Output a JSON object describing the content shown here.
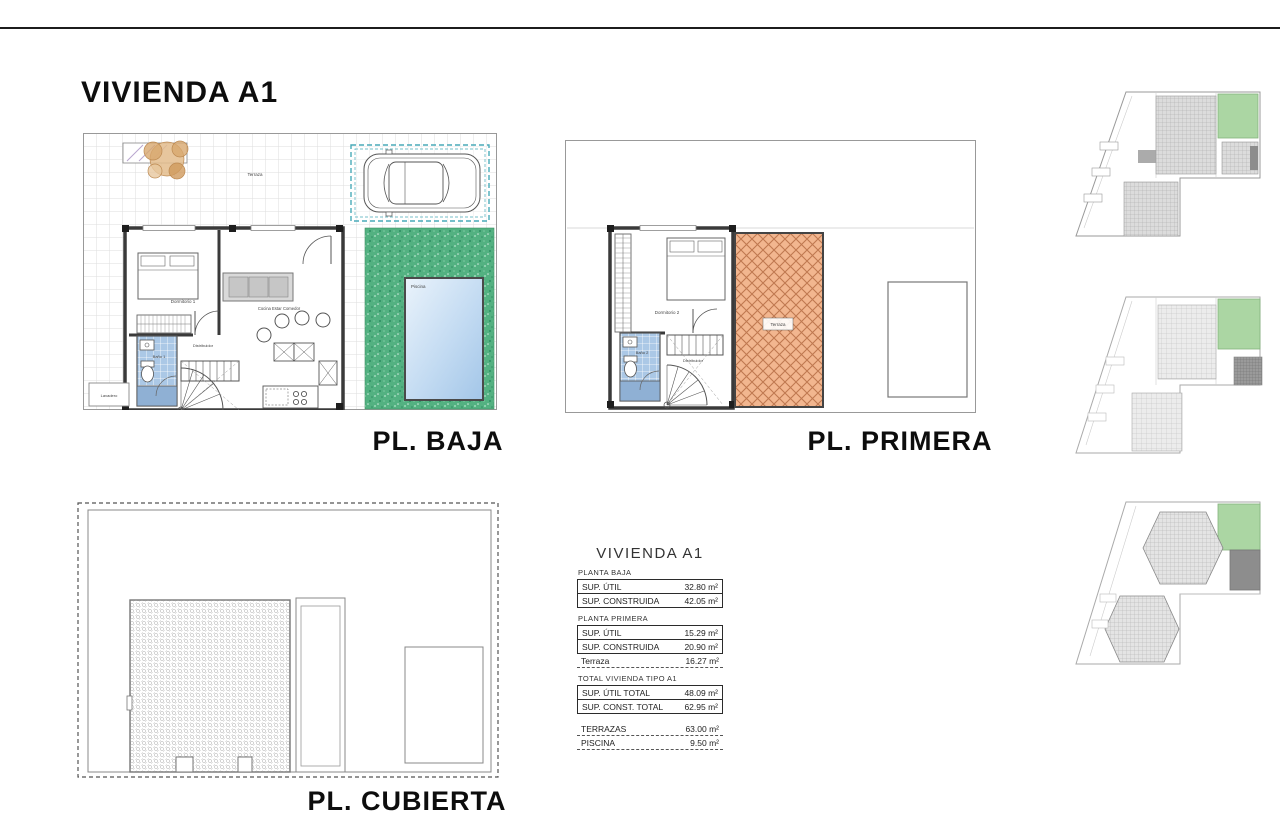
{
  "page": {
    "title": "VIVIENDA A1"
  },
  "plans": {
    "baja": {
      "label": "PL. BAJA",
      "terraza": "Terraza",
      "dormitorio": "Dormitorio 1",
      "salon": "Cocina Estar Comedor",
      "distribuidor": "Distribuidor",
      "bano": "Baño 1",
      "lavadero": "Lavadero",
      "piscina": "Piscina"
    },
    "primera": {
      "label": "PL. PRIMERA",
      "dormitorio": "Dormitorio 2",
      "bano": "Baño 2",
      "distribuidor": "Distribuidor",
      "terraza": "Terraza"
    },
    "cubierta": {
      "label": "PL. CUBIERTA"
    }
  },
  "table": {
    "title": "VIVIENDA A1",
    "planta_baja": {
      "heading": "PLANTA BAJA",
      "rows": [
        {
          "label": "SUP. ÚTIL",
          "value": "32.80 m²"
        },
        {
          "label": "SUP. CONSTRUIDA",
          "value": "42.05 m²"
        }
      ]
    },
    "planta_primera": {
      "heading": "PLANTA PRIMERA",
      "rows": [
        {
          "label": "SUP. ÚTIL",
          "value": "15.29 m²"
        },
        {
          "label": "SUP. CONSTRUIDA",
          "value": "20.90 m²"
        }
      ],
      "terraza": {
        "label": "Terraza",
        "value": "16.27 m²"
      }
    },
    "total": {
      "heading": "TOTAL VIVIENDA TIPO A1",
      "rows": [
        {
          "label": "SUP. ÚTIL TOTAL",
          "value": "48.09 m²"
        },
        {
          "label": "SUP. CONST. TOTAL",
          "value": "62.95 m²"
        }
      ]
    },
    "extras": [
      {
        "label": "TERRAZAS",
        "value": "63.00 m²"
      },
      {
        "label": "PISCINA",
        "value": "9.50 m²"
      }
    ]
  },
  "colors": {
    "garden": "#53b181",
    "terrace_tile": "#f2b68f",
    "pool": "#bcd7f0",
    "bath_tile": "#abc8e6",
    "highlight_unit": "#abd6a3",
    "parking_dash": "#49aab8"
  }
}
